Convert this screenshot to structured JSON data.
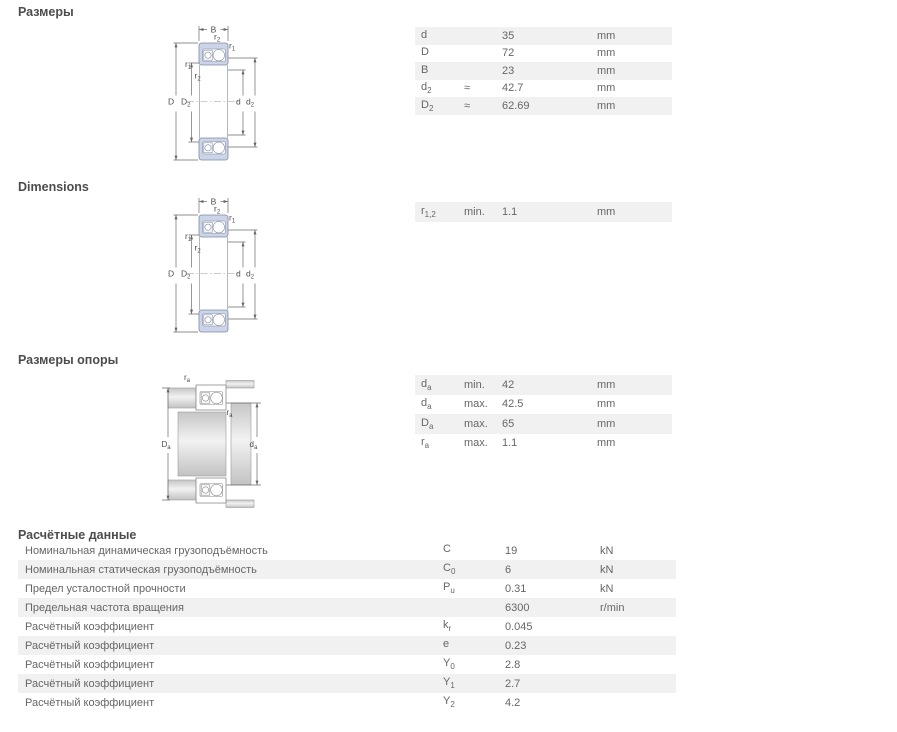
{
  "page": {
    "background": "#ffffff",
    "text_color": "#666666",
    "heading_color": "#4d4d4d",
    "stripe_color": "#f1f1f1",
    "bearing_fill": "#ccd5e8"
  },
  "sections": {
    "dimensions_ru": {
      "title": "Размеры",
      "rows": [
        {
          "symbol": {
            "base": "d",
            "sub": ""
          },
          "qualifier": "",
          "value": "35",
          "unit": "mm"
        },
        {
          "symbol": {
            "base": "D",
            "sub": ""
          },
          "qualifier": "",
          "value": "72",
          "unit": "mm"
        },
        {
          "symbol": {
            "base": "B",
            "sub": ""
          },
          "qualifier": "",
          "value": "23",
          "unit": "mm"
        },
        {
          "symbol": {
            "base": "d",
            "sub": "2"
          },
          "qualifier": "≈",
          "value": "42.7",
          "unit": "mm"
        },
        {
          "symbol": {
            "base": "D",
            "sub": "2"
          },
          "qualifier": "≈",
          "value": "62.69",
          "unit": "mm"
        }
      ]
    },
    "dimensions_en": {
      "title": "Dimensions",
      "rows": [
        {
          "symbol": {
            "base": "r",
            "sub": "1,2"
          },
          "qualifier": "min.",
          "value": "1.1",
          "unit": "mm"
        }
      ]
    },
    "abutment": {
      "title": "Размеры опоры",
      "rows": [
        {
          "symbol": {
            "base": "d",
            "sub": "a"
          },
          "qualifier": "min.",
          "value": "42",
          "unit": "mm"
        },
        {
          "symbol": {
            "base": "d",
            "sub": "a"
          },
          "qualifier": "max.",
          "value": "42.5",
          "unit": "mm"
        },
        {
          "symbol": {
            "base": "D",
            "sub": "a"
          },
          "qualifier": "max.",
          "value": "65",
          "unit": "mm"
        },
        {
          "symbol": {
            "base": "r",
            "sub": "a"
          },
          "qualifier": "max.",
          "value": "1.1",
          "unit": "mm"
        }
      ]
    },
    "calculation": {
      "title": "Расчётные данные",
      "rows": [
        {
          "label": "Номинальная динамическая грузоподъёмность",
          "symbol": {
            "base": "C",
            "sub": ""
          },
          "value": "19",
          "unit": "kN"
        },
        {
          "label": "Номинальная статическая грузоподъёмность",
          "symbol": {
            "base": "C",
            "sub": "0"
          },
          "value": "6",
          "unit": "kN"
        },
        {
          "label": "Предел усталостной прочности",
          "symbol": {
            "base": "P",
            "sub": "u"
          },
          "value": "0.31",
          "unit": "kN"
        },
        {
          "label": "Предельная частота вращения",
          "symbol": {
            "base": "",
            "sub": ""
          },
          "value": "6300",
          "unit": "r/min"
        },
        {
          "label": "Расчётный коэффициент",
          "symbol": {
            "base": "k",
            "sub": "r"
          },
          "value": "0.045",
          "unit": ""
        },
        {
          "label": "Расчётный коэффициент",
          "symbol": {
            "base": "e",
            "sub": ""
          },
          "value": "0.23",
          "unit": ""
        },
        {
          "label": "Расчётный коэффициент",
          "symbol": {
            "base": "Y",
            "sub": "0"
          },
          "value": "2.8",
          "unit": ""
        },
        {
          "label": "Расчётный коэффициент",
          "symbol": {
            "base": "Y",
            "sub": "1"
          },
          "value": "2.7",
          "unit": ""
        },
        {
          "label": "Расчётный коэффициент",
          "symbol": {
            "base": "Y",
            "sub": "2"
          },
          "value": "4.2",
          "unit": ""
        }
      ]
    }
  },
  "diagram": {
    "B": "B",
    "D": "D",
    "d": "d",
    "r": "r",
    "sub_1": "1",
    "sub_2": "2",
    "sub_a": "a"
  }
}
